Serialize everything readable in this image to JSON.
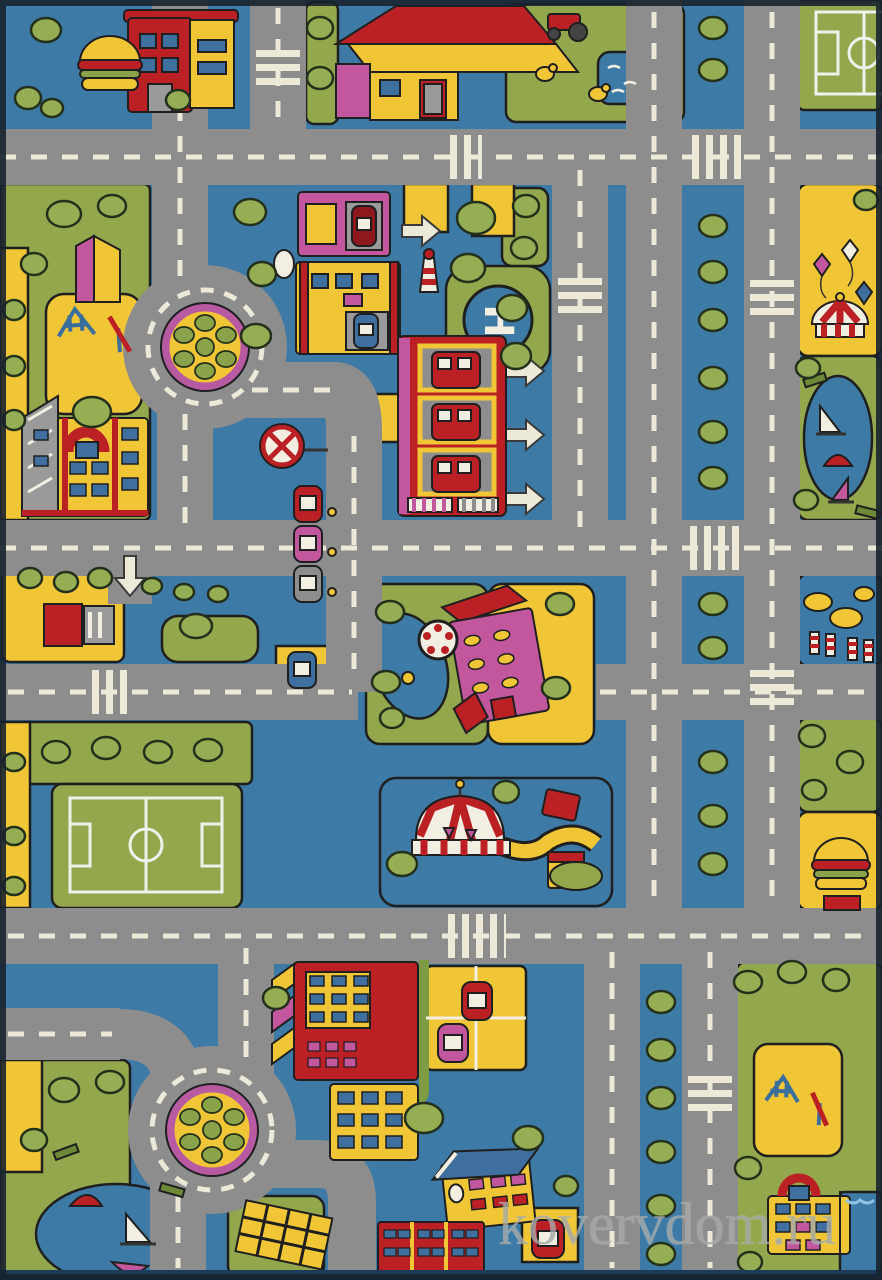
{
  "scene": {
    "description": "Children's play rug photographed from above: toy city road map with gray roads, dashed markings, parks, buildings and vehicles",
    "width": 882,
    "height": 1280
  },
  "watermark": {
    "text": "kovervdom.ru",
    "color": "#a6aaa9"
  },
  "helipad": {
    "letter": "H"
  },
  "palette": {
    "background": "#3d7aa6",
    "road": "#8d8d8d",
    "marking": "#ece9d8",
    "grass": "#93a74c",
    "tree": "#95ad53",
    "tree_outline": "#22301c",
    "yellow": "#f0c636",
    "red": "#bb2025",
    "dark_red": "#8e161d",
    "magenta": "#c2579e",
    "window_blue": "#3f6f9e",
    "white": "#f2efe2",
    "outline": "#1f1f1f",
    "gray_building": "#9a9a9a",
    "edge": "#17222e"
  },
  "landmarks": [
    {
      "id": "burger-restaurant-top-left",
      "label": "Burger restaurant"
    },
    {
      "id": "street-kiosk",
      "label": "Small kiosk"
    },
    {
      "id": "farm-house",
      "label": "Farm house with red and yellow roof"
    },
    {
      "id": "farm-yard",
      "label": "Farm yard with chickens, pond and tractor"
    },
    {
      "id": "soccer-field-top-right",
      "label": "Soccer field (partially cropped)"
    },
    {
      "id": "shops-row",
      "label": "Row of shops with service bays and cars"
    },
    {
      "id": "lighthouse",
      "label": "Small striped lighthouse"
    },
    {
      "id": "helipad",
      "label": "Helipad with letter H"
    },
    {
      "id": "fire-station",
      "label": "Fire station with three truck bays"
    },
    {
      "id": "exit-arrows",
      "label": "Three white exit arrows"
    },
    {
      "id": "school-left",
      "label": "School building with red arched entrance"
    },
    {
      "id": "playground-left",
      "label": "Playground with swing and slide"
    },
    {
      "id": "roundabout-upper",
      "label": "Roundabout with planted island"
    },
    {
      "id": "roundabout-lower",
      "label": "Roundabout with planted island"
    },
    {
      "id": "no-parking-sign",
      "label": "Round crossed traffic sign"
    },
    {
      "id": "parked-cars",
      "label": "Three parked cars"
    },
    {
      "id": "gas-station",
      "label": "Gas station with pumps and entry arrow"
    },
    {
      "id": "pink-school",
      "label": "Pink building with red roofs"
    },
    {
      "id": "water-wheel-pond",
      "label": "Pond with white water wheel and duck"
    },
    {
      "id": "amusement-park-right",
      "label": "Park with carousel and kites"
    },
    {
      "id": "boat-pond-right",
      "label": "Pond with sailing boats"
    },
    {
      "id": "sand-barriers",
      "label": "Sand piles with striped barriers"
    },
    {
      "id": "burger-restaurant-right",
      "label": "Burger stand with red awning"
    },
    {
      "id": "circus-tent",
      "label": "Red and white striped circus tent"
    },
    {
      "id": "ticket-booths",
      "label": "Circus ticket booths"
    },
    {
      "id": "soccer-field-bottom-left",
      "label": "Soccer field"
    },
    {
      "id": "apartment-building",
      "label": "Red apartment building"
    },
    {
      "id": "parking-lot",
      "label": "Yellow parking lot with cars"
    },
    {
      "id": "blue-roof-house",
      "label": "Yellow house with blue roof"
    },
    {
      "id": "brick-houses",
      "label": "Red brick row houses"
    },
    {
      "id": "scaffold-frame",
      "label": "Yellow climbing frame"
    },
    {
      "id": "boat-pond-bottom-left",
      "label": "Park pond with sail boats"
    },
    {
      "id": "playground-bottom-right",
      "label": "Playground with swing and slide"
    },
    {
      "id": "school-bottom-right",
      "label": "Building with red arched entrance"
    },
    {
      "id": "swimming-pool",
      "label": "Blue pool"
    },
    {
      "id": "road-network",
      "label": "Gray roads with dashed lines and crosswalks"
    }
  ]
}
